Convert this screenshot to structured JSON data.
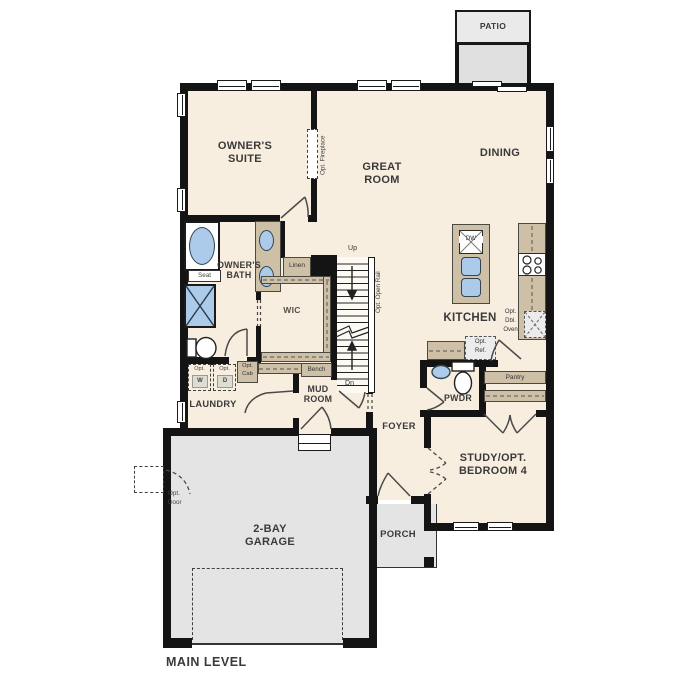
{
  "plan_title": "MAIN LEVEL",
  "rooms": {
    "patio": "PATIO",
    "owners_suite": "OWNER'S SUITE",
    "great_room": "GREAT ROOM",
    "dining": "DINING",
    "owners_bath": "OWNER'S BATH",
    "wic": "WIC",
    "kitchen": "KITCHEN",
    "laundry": "LAUNDRY",
    "mud_room": "MUD ROOM",
    "foyer": "FOYER",
    "pwdr": "PWDR",
    "study": "STUDY/OPT. BEDROOM 4",
    "garage": "2-BAY GARAGE",
    "porch": "PORCH"
  },
  "annotations": {
    "opt_fireplace": "Opt. Fireplace",
    "opt_open_rail": "Opt. Open Rail",
    "linen": "Linen",
    "seat": "Seat",
    "up": "Up",
    "dn": "Dn",
    "bench": "Bench",
    "pantry": "Pantry",
    "opt": "Opt.",
    "w": "W",
    "d": "D",
    "cab": "Cab",
    "ref": "Ref.",
    "dbl": "Dbl.",
    "oven": "Oven",
    "door": "Door",
    "dw": "DW"
  },
  "colors": {
    "wall": "#141414",
    "floor": "#f7eedf",
    "cabinet": "#cec0a7",
    "garage_slab": "#e4e4e4",
    "patio_slab": "#e7e7e7",
    "fixture_blue": "#accae9"
  }
}
